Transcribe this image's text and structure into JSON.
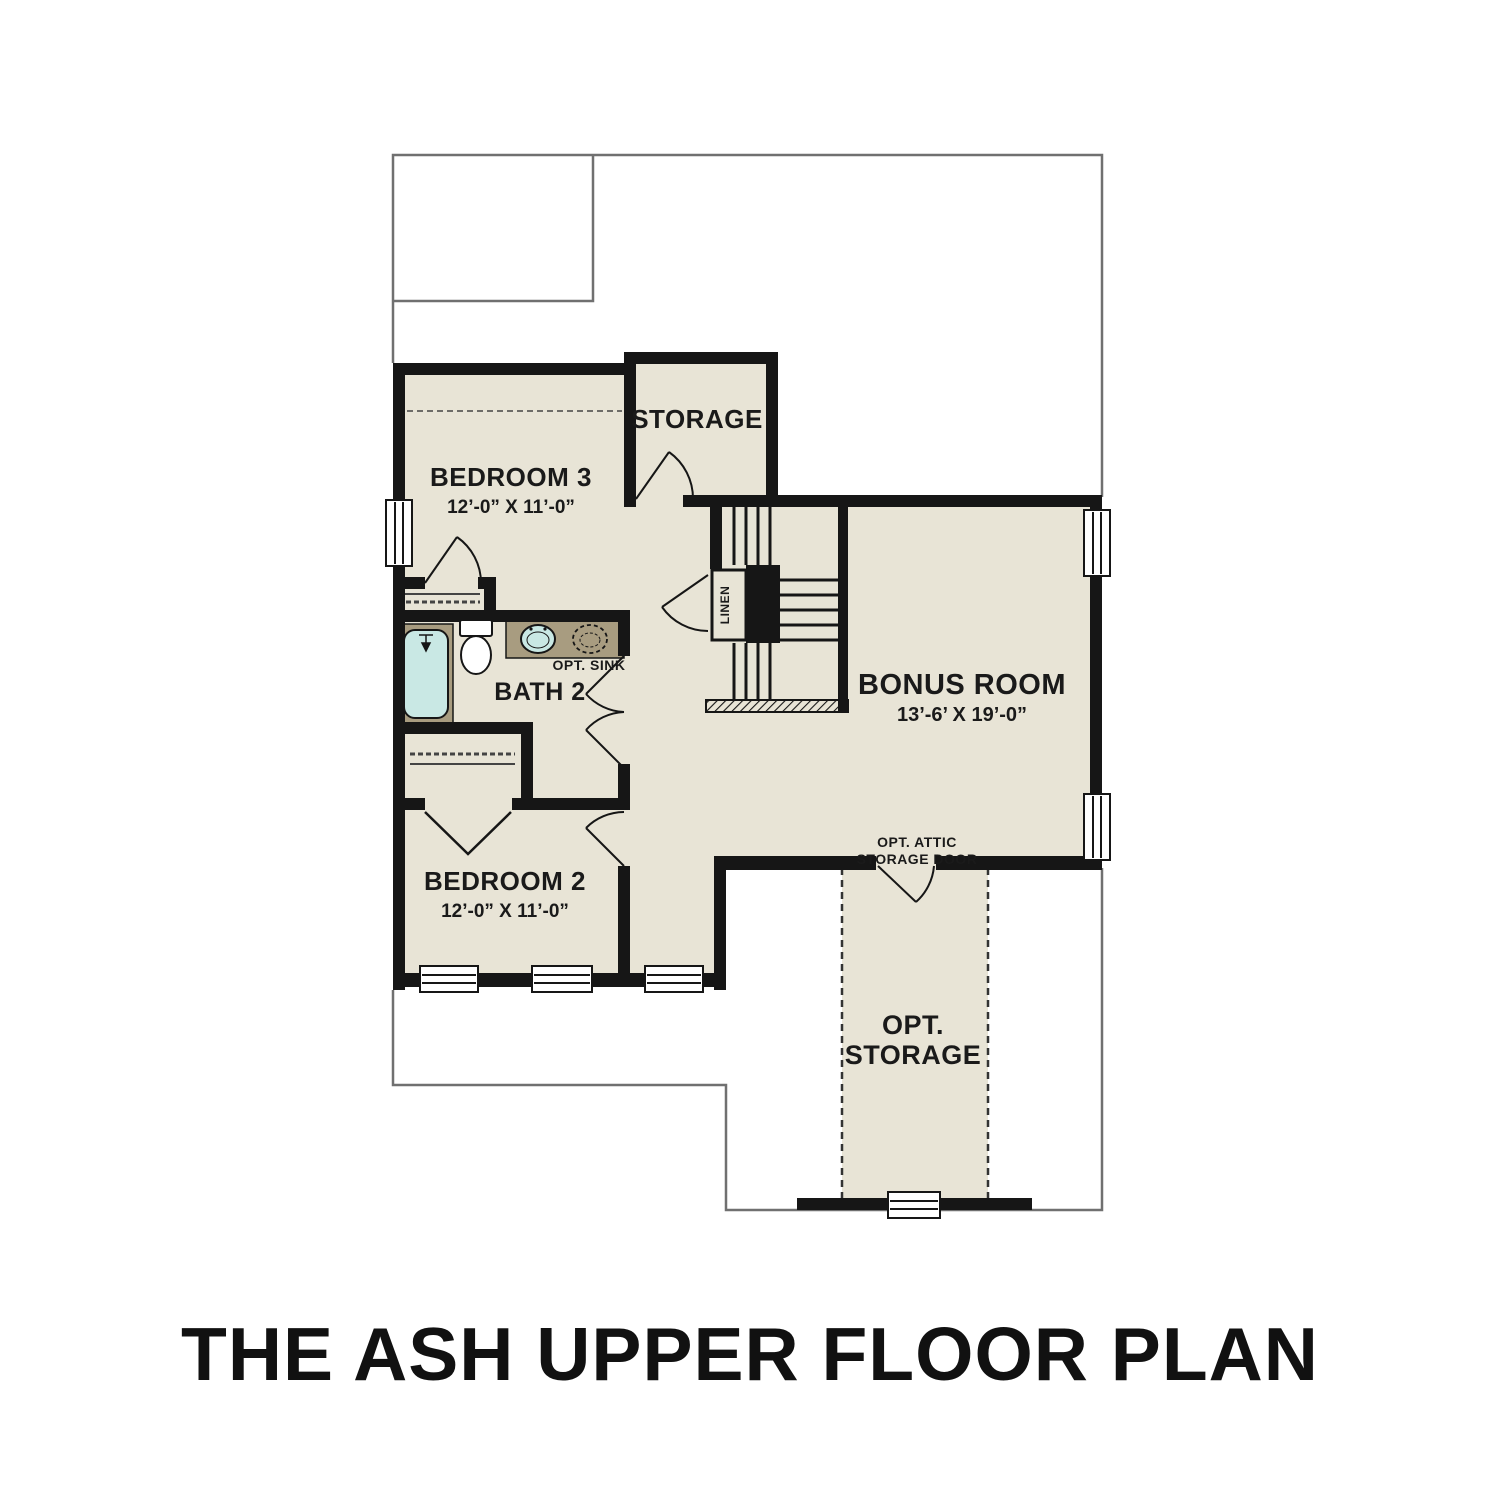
{
  "title": "THE ASH UPPER FLOOR PLAN",
  "rooms": {
    "bedroom3": {
      "name": "BEDROOM 3",
      "dims": "12’-0” X 11’-0”"
    },
    "storage": {
      "name": "STORAGE"
    },
    "bath2": {
      "name": "BATH 2"
    },
    "bonus": {
      "name": "BONUS ROOM",
      "dims": "13’-6’ X 19’-0”"
    },
    "bedroom2": {
      "name": "BEDROOM 2",
      "dims": "12’-0” X 11’-0”"
    },
    "opt_storage": {
      "line1": "OPT.",
      "line2": "STORAGE"
    }
  },
  "annotations": {
    "opt_sink": "OPT. SINK",
    "linen": "LINEN",
    "attic_line1": "OPT. ATTIC",
    "attic_line2": "STORAGE DOOR"
  },
  "colors": {
    "floor": "#e8e4d6",
    "counter": "#a89c80",
    "water": "#c9e8e4",
    "wall": "#161616",
    "outline": "#707070",
    "text": "#1a1a1a"
  }
}
